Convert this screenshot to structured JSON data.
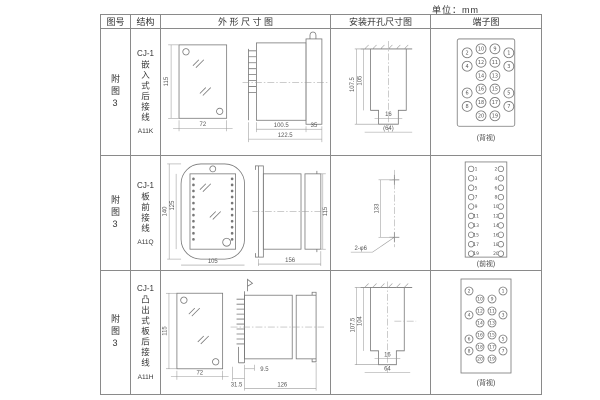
{
  "unit_label": "单位：mm",
  "table": {
    "headers": [
      "图号",
      "结构",
      "外 形 尺 寸 图",
      "安装开孔尺寸图",
      "端子图"
    ],
    "rows": [
      {
        "figure_no": "附图3",
        "series": "CJ-1",
        "structure": "嵌入式后接线",
        "model": "A11K",
        "outline": {
          "front_h": "115",
          "front_w": "72",
          "side_d1": "100.5",
          "side_d2": "35",
          "side_d3": "122.5"
        },
        "install": {
          "v1": "107.5",
          "v2": "105",
          "b1": "16",
          "b2": "(64)"
        },
        "terminal": {
          "type": "grid",
          "caption": "(背视)",
          "rows": [
            [
              "2",
              "10",
              "9",
              "1"
            ],
            [
              "4",
              "12",
              "11",
              "3"
            ],
            [
              "",
              "14",
              "13",
              ""
            ],
            [
              "6",
              "16",
              "15",
              "5"
            ],
            [
              "8",
              "18",
              "17",
              "7"
            ],
            [
              "",
              "20",
              "19",
              ""
            ]
          ]
        }
      },
      {
        "figure_no": "附图3",
        "series": "CJ-1",
        "structure": "板前接线",
        "model": "A11Q",
        "outline": {
          "front_h_outer": "140",
          "front_h_inner": "125",
          "front_w": "105",
          "side_h": "115",
          "side_len": "156"
        },
        "install": {
          "v1": "133",
          "hole_label": "2-φ6"
        },
        "terminal": {
          "type": "pairs",
          "caption": "(前视)",
          "left": [
            "1",
            "3",
            "5",
            "7",
            "9",
            "11",
            "13",
            "15",
            "17",
            "19"
          ],
          "right": [
            "2",
            "4",
            "6",
            "8",
            "10",
            "12",
            "14",
            "16",
            "18",
            "20"
          ]
        }
      },
      {
        "figure_no": "附图3",
        "series": "CJ-1",
        "structure": "凸出式板后接线",
        "model": "A11H",
        "outline": {
          "front_h": "115",
          "front_w": "72",
          "side_d1": "9.5",
          "side_d2": "31.5",
          "side_d3": "126"
        },
        "install": {
          "v1": "107.5",
          "v2": "104",
          "b1": "16",
          "b2": "64"
        },
        "terminal": {
          "type": "grid",
          "caption": "(背视)",
          "rows": [
            [
              "2",
              "",
              "",
              "1"
            ],
            [
              "",
              "10",
              "9",
              ""
            ],
            [
              "4",
              "12",
              "11",
              "3"
            ],
            [
              "",
              "14",
              "13",
              ""
            ],
            [
              "6",
              "16",
              "15",
              "5"
            ],
            [
              "8",
              "18",
              "17",
              "7"
            ],
            [
              "",
              "20",
              "19",
              ""
            ]
          ]
        }
      }
    ]
  }
}
